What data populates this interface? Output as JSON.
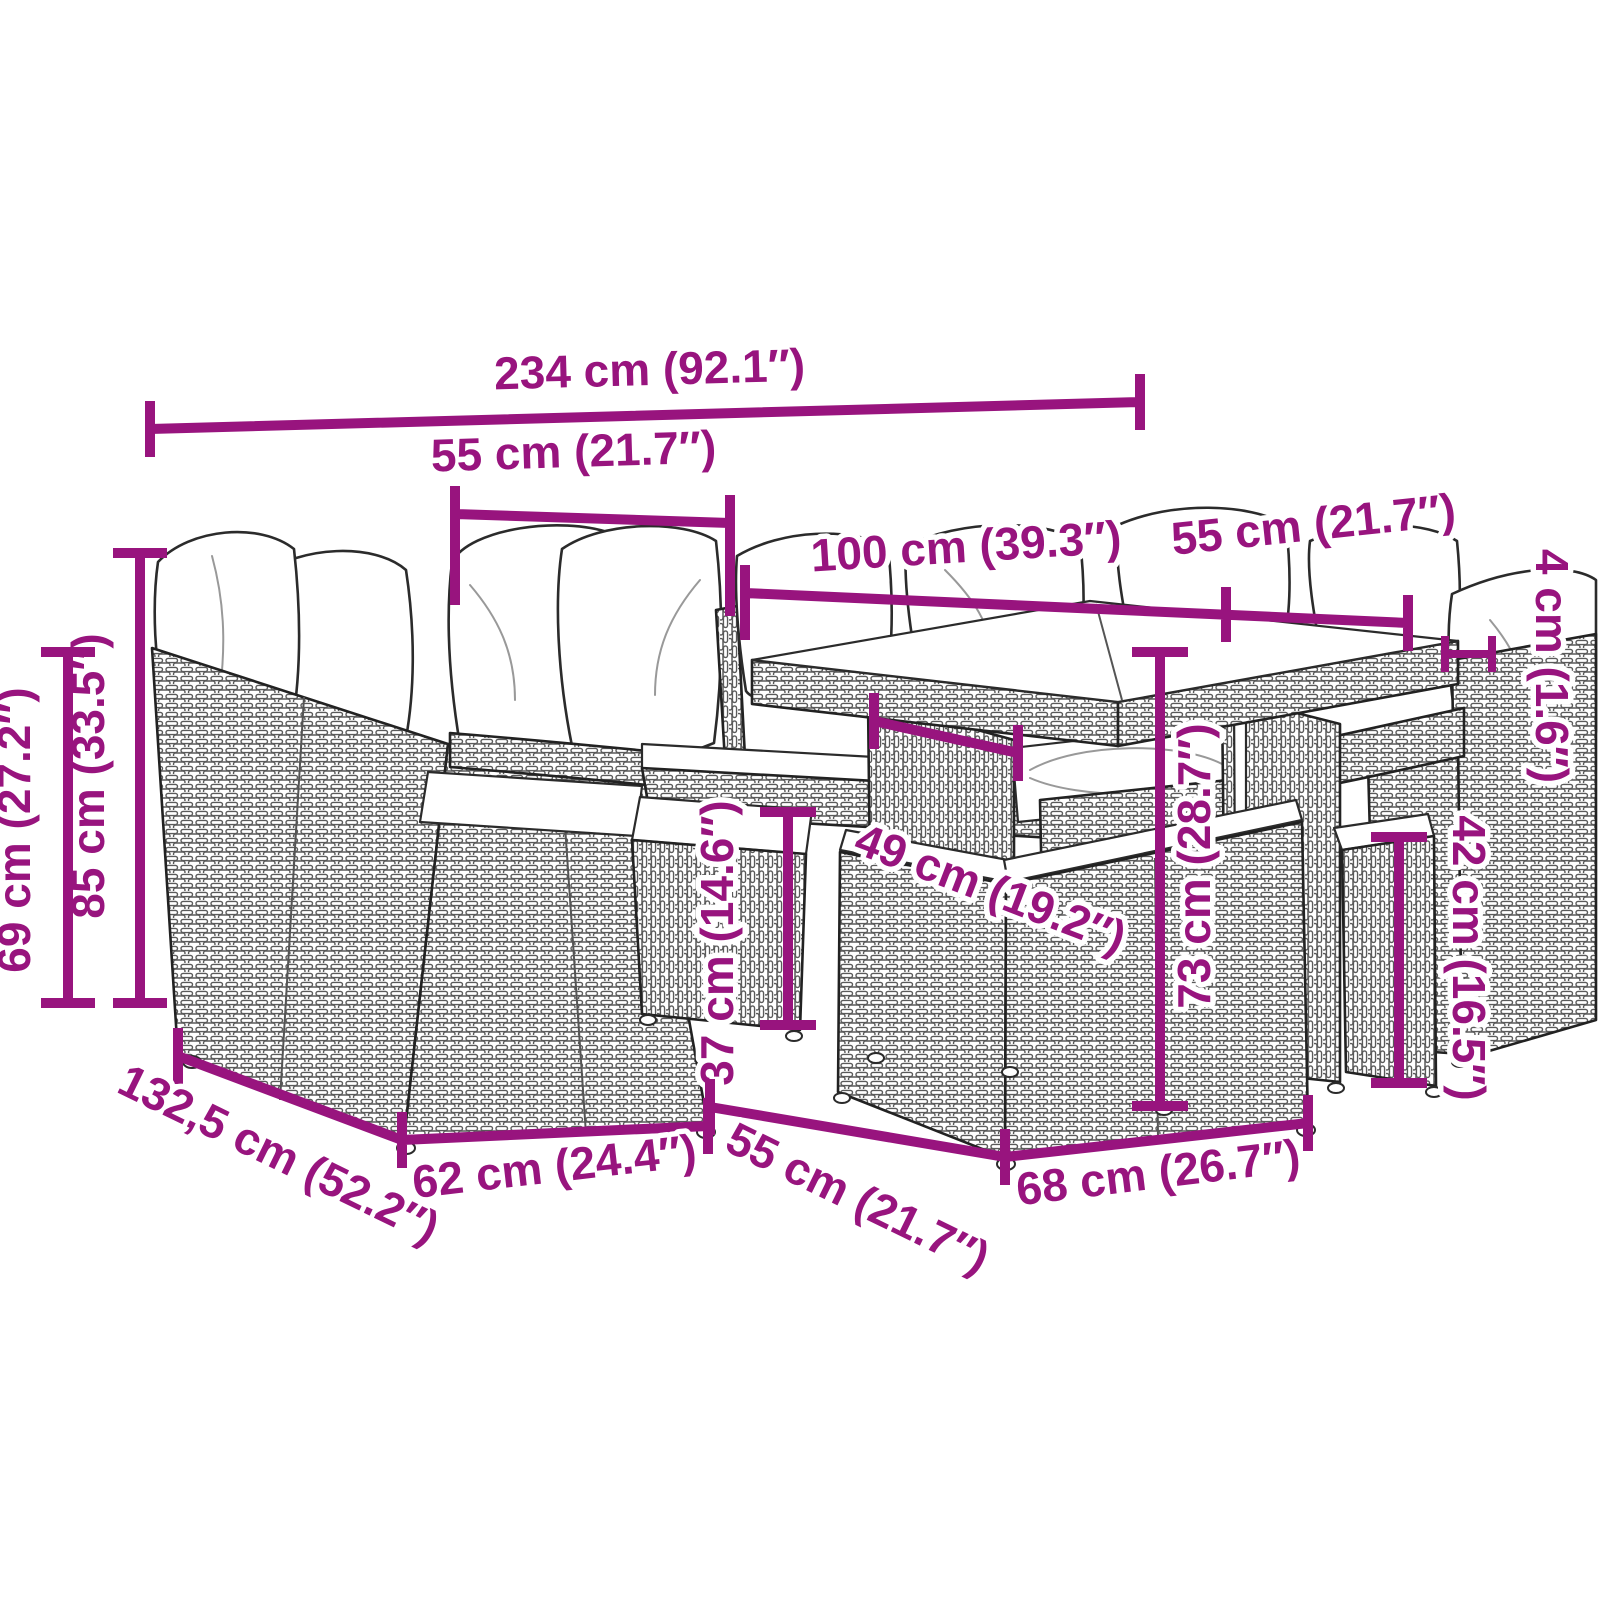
{
  "diagram": {
    "style": {
      "accent_color": "#98147E",
      "line_art_color": "#222222",
      "background_color": "#FFFFFF"
    },
    "dimensions": {
      "overall_width": "234 cm (92.1″)",
      "backrest_module_width": "55 cm (21.7″)",
      "table_length": "100 cm (39.3″)",
      "table_width": "55 cm (21.7″)",
      "tabletop_thickness": "4 cm (1.6″)",
      "backrest_height": "85 cm (33.5″)",
      "armrest_height": "69 cm (27.2″)",
      "seat_depth": "49 cm (19.2″)",
      "seat_height": "37 cm (14.6″)",
      "table_height": "73 cm (28.7″)",
      "stool_height": "42 cm (16.5″)",
      "overall_depth": "132,5 cm (52.2″)",
      "seat_module_width": "62 cm (24.4″)",
      "ottoman_depth": "55 cm (21.7″)",
      "ottoman_width": "68 cm (26.7″)"
    }
  }
}
